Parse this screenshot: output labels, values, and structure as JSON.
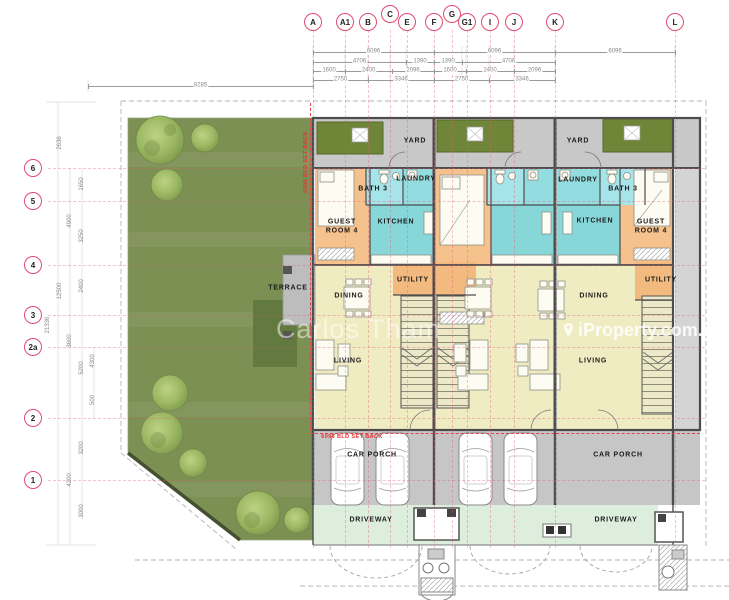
{
  "watermarks": {
    "agent": "Carlos Tham",
    "portal": "iProperty.com.my"
  },
  "setback_notes": [
    {
      "text": "6096 BLD SET BACK",
      "x": 306,
      "y": 162,
      "vertical": true
    },
    {
      "text": "6096 BLD SET BACK",
      "x": 352,
      "y": 437,
      "vertical": false
    }
  ],
  "grid": {
    "top_bubbles": [
      {
        "label": "A",
        "x": 313,
        "y": 22
      },
      {
        "label": "A1",
        "x": 345,
        "y": 22
      },
      {
        "label": "B",
        "x": 368,
        "y": 22
      },
      {
        "label": "C",
        "x": 390,
        "y": 14
      },
      {
        "label": "E",
        "x": 407,
        "y": 22
      },
      {
        "label": "F",
        "x": 434,
        "y": 22
      },
      {
        "label": "G",
        "x": 452,
        "y": 14
      },
      {
        "label": "G1",
        "x": 467,
        "y": 22
      },
      {
        "label": "I",
        "x": 490,
        "y": 22
      },
      {
        "label": "J",
        "x": 514,
        "y": 22
      },
      {
        "label": "K",
        "x": 555,
        "y": 22
      },
      {
        "label": "L",
        "x": 675,
        "y": 22
      }
    ],
    "left_bubbles": [
      {
        "label": "6",
        "y": 168
      },
      {
        "label": "5",
        "y": 201
      },
      {
        "label": "4",
        "y": 265
      },
      {
        "label": "3",
        "y": 315
      },
      {
        "label": "2a",
        "y": 347
      },
      {
        "label": "2",
        "y": 418
      },
      {
        "label": "1",
        "y": 480
      }
    ]
  },
  "dimensions": {
    "top_rows": [
      {
        "y": 52,
        "segments": [
          {
            "text": "6096",
            "x1": 313,
            "x2": 434
          },
          {
            "text": "6096",
            "x1": 434,
            "x2": 555
          },
          {
            "text": "6096",
            "x1": 555,
            "x2": 675
          }
        ]
      },
      {
        "y": 62,
        "segments": [
          {
            "text": "4706",
            "x1": 313,
            "x2": 406
          },
          {
            "text": "1390",
            "x1": 406,
            "x2": 434
          },
          {
            "text": "1390",
            "x1": 434,
            "x2": 462
          },
          {
            "text": "4706",
            "x1": 462,
            "x2": 555
          }
        ]
      },
      {
        "y": 71,
        "segments": [
          {
            "text": "1600",
            "x1": 313,
            "x2": 345
          },
          {
            "text": "2400",
            "x1": 345,
            "x2": 392
          },
          {
            "text": "2096",
            "x1": 392,
            "x2": 434
          },
          {
            "text": "1600",
            "x1": 434,
            "x2": 466
          },
          {
            "text": "2400",
            "x1": 466,
            "x2": 514
          },
          {
            "text": "2096",
            "x1": 514,
            "x2": 555
          }
        ]
      },
      {
        "y": 80,
        "segments": [
          {
            "text": "2750",
            "x1": 313,
            "x2": 368
          },
          {
            "text": "3346",
            "x1": 368,
            "x2": 434
          },
          {
            "text": "2750",
            "x1": 434,
            "x2": 489
          },
          {
            "text": "3346",
            "x1": 489,
            "x2": 555
          }
        ]
      },
      {
        "y": 86,
        "segments": [
          {
            "text": "8285",
            "x1": 88,
            "x2": 313
          }
        ]
      }
    ],
    "left_column": [
      {
        "text": "2636",
        "x": 60,
        "y": 143
      },
      {
        "text": "1650",
        "x": 82,
        "y": 184
      },
      {
        "text": "4900",
        "x": 70,
        "y": 221
      },
      {
        "text": "3250",
        "x": 82,
        "y": 236
      },
      {
        "text": "12500",
        "x": 60,
        "y": 291
      },
      {
        "text": "2400",
        "x": 82,
        "y": 286
      },
      {
        "text": "21336",
        "x": 48,
        "y": 325
      },
      {
        "text": "3600",
        "x": 70,
        "y": 341
      },
      {
        "text": "4300",
        "x": 93,
        "y": 361
      },
      {
        "text": "5200",
        "x": 82,
        "y": 368
      },
      {
        "text": "500",
        "x": 93,
        "y": 400
      },
      {
        "text": "3200",
        "x": 82,
        "y": 448
      },
      {
        "text": "4200",
        "x": 70,
        "y": 480
      },
      {
        "text": "3000",
        "x": 82,
        "y": 511
      }
    ]
  },
  "rooms": [
    {
      "name": "YARD",
      "x": 415,
      "y": 142
    },
    {
      "name": "BATH 3",
      "x": 373,
      "y": 190
    },
    {
      "name": "LAUNDRY",
      "x": 416,
      "y": 180
    },
    {
      "name": "GUEST\nROOM 4",
      "x": 342,
      "y": 227
    },
    {
      "name": "KITCHEN",
      "x": 396,
      "y": 223
    },
    {
      "name": "TERRACE",
      "x": 288,
      "y": 289
    },
    {
      "name": "DINING",
      "x": 349,
      "y": 297
    },
    {
      "name": "UTILITY",
      "x": 413,
      "y": 281
    },
    {
      "name": "LIVING",
      "x": 348,
      "y": 362
    },
    {
      "name": "CAR PORCH",
      "x": 372,
      "y": 456
    },
    {
      "name": "DRIVEWAY",
      "x": 371,
      "y": 521
    },
    {
      "name": "YARD",
      "x": 578,
      "y": 142
    },
    {
      "name": "LAUNDRY",
      "x": 578,
      "y": 181
    },
    {
      "name": "BATH 3",
      "x": 623,
      "y": 190
    },
    {
      "name": "KITCHEN",
      "x": 595,
      "y": 222
    },
    {
      "name": "GUEST\nROOM 4",
      "x": 651,
      "y": 227
    },
    {
      "name": "DINING",
      "x": 594,
      "y": 297
    },
    {
      "name": "UTILITY",
      "x": 661,
      "y": 281
    },
    {
      "name": "LIVING",
      "x": 593,
      "y": 362
    },
    {
      "name": "CAR PORCH",
      "x": 618,
      "y": 456
    },
    {
      "name": "DRIVEWAY",
      "x": 616,
      "y": 521
    }
  ]
}
